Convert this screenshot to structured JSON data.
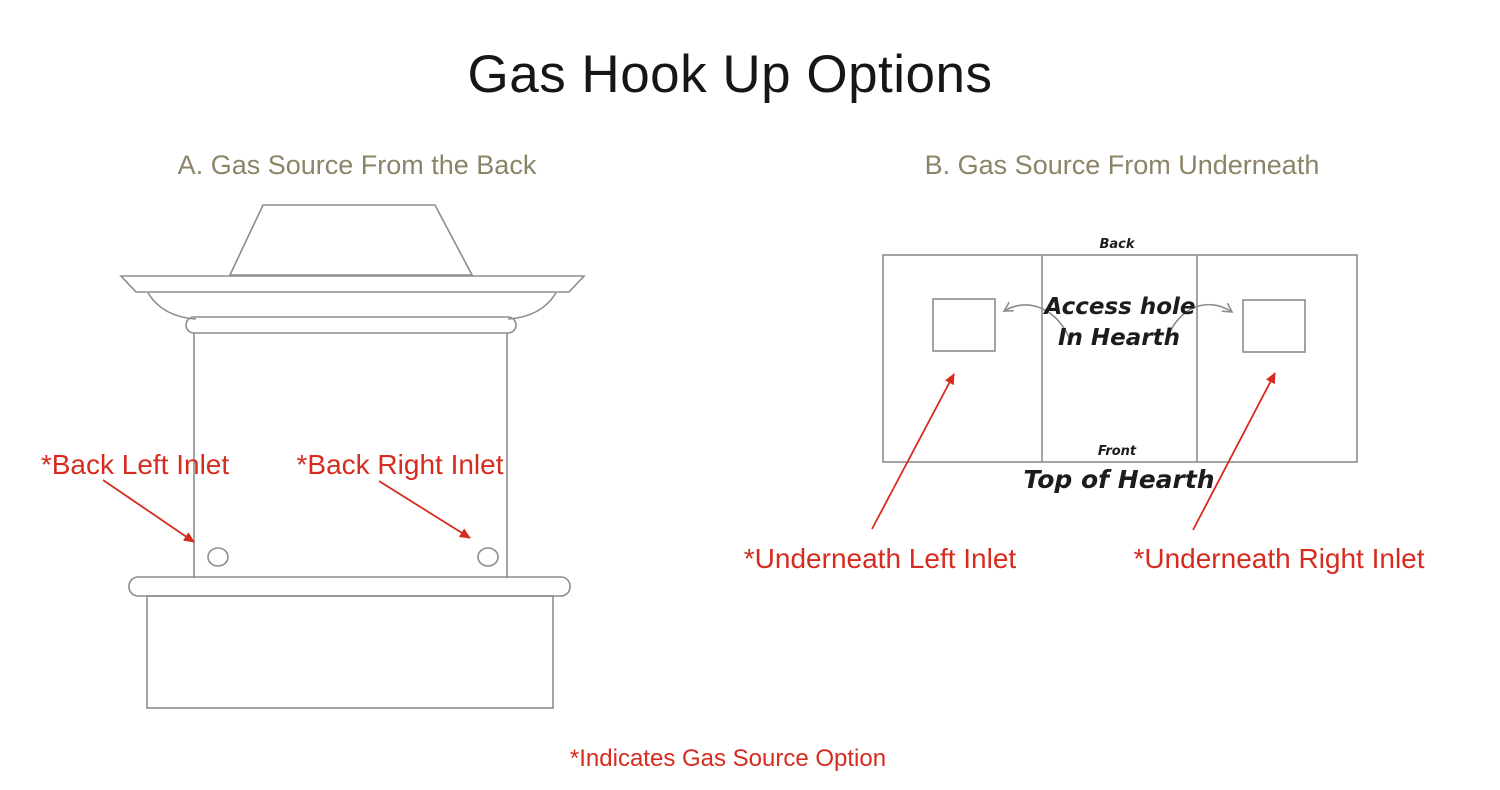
{
  "title": "Gas Hook Up Options",
  "footnote": "*Indicates Gas Source Option",
  "colors": {
    "accent_red": "#d62c20",
    "heading_olive": "#8c8468",
    "line_gray": "#8d8d8d",
    "text_dark": "#1c1c1c"
  },
  "section_a": {
    "heading": "A. Gas Source From the Back",
    "back_left_label": "*Back Left Inlet",
    "back_right_label": "*Back Right Inlet"
  },
  "section_b": {
    "heading": "B. Gas Source From Underneath",
    "back_label": "Back",
    "front_label": "Front",
    "access_hole_line1": "Access hole",
    "access_hole_line2": "In Hearth",
    "caption": "Top of Hearth",
    "underneath_left_label": "*Underneath Left Inlet",
    "underneath_right_label": "*Underneath Right Inlet"
  }
}
